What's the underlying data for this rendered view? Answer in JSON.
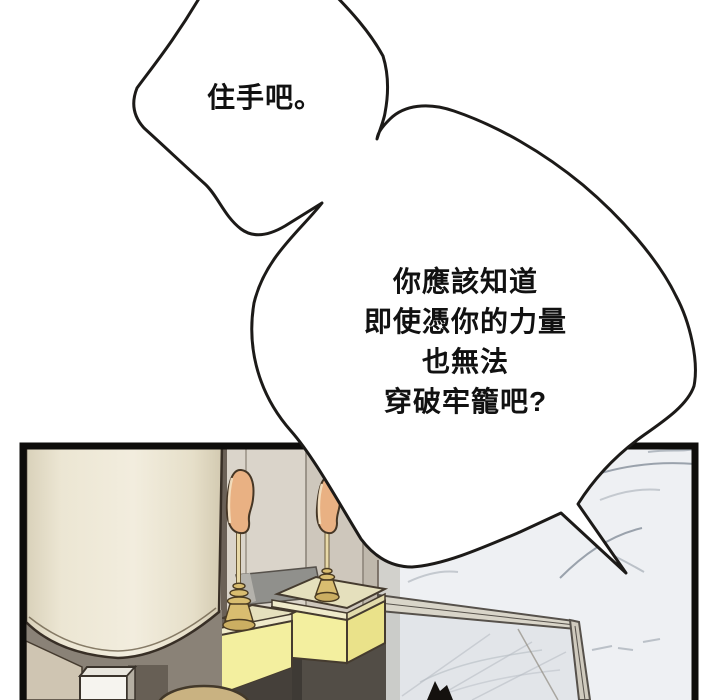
{
  "page": {
    "kind": "webtoon-comic-panel",
    "background": "#ffffff"
  },
  "speech_bubbles": [
    {
      "id": "bubble-1",
      "text": "住手吧。"
    },
    {
      "id": "bubble-2",
      "lines": [
        "你應該知道",
        "即使憑你的力量",
        "也無法",
        "穿破牢籠吧?"
      ]
    }
  ],
  "scene_objects": [
    "lamp-shade",
    "lamp-base-post",
    "floor-wedge",
    "stool-cushion",
    "pedestal-box-1",
    "pedestal-box-2",
    "gold-ornament-1",
    "gold-ornament-2",
    "wall-niche",
    "marble-wall",
    "glass-display-case",
    "bubble-tail-spike"
  ],
  "colors": {
    "ink": "#1c1a18",
    "panel_border": "#0e0d0b",
    "wall": "#d6d0c6",
    "wall_light": "#dad4ca",
    "wall_mid": "#cec7bc",
    "wall_dark": "#bfb8ac",
    "wall_strip": "#6b6157",
    "niche": "#90908c",
    "marble": "#eef0f3",
    "marble_vein": "#9aa2ac",
    "lamp_cream": "#f2edde",
    "lamp_edge": "#ddd5bf",
    "box_yellow": "#f3ef9f",
    "box_yellow_side": "#eae28a",
    "box_top": "#e5e0bd",
    "gold": "#d9bd70",
    "gold_dark": "#cbae62",
    "peach": "#e9b183",
    "peach_highlight": "#f3dfc0",
    "stool": "#c9b281",
    "shadow": "#524d46",
    "glass_tint": "#aeb6bd",
    "bubble_fill": "#ffffff"
  }
}
